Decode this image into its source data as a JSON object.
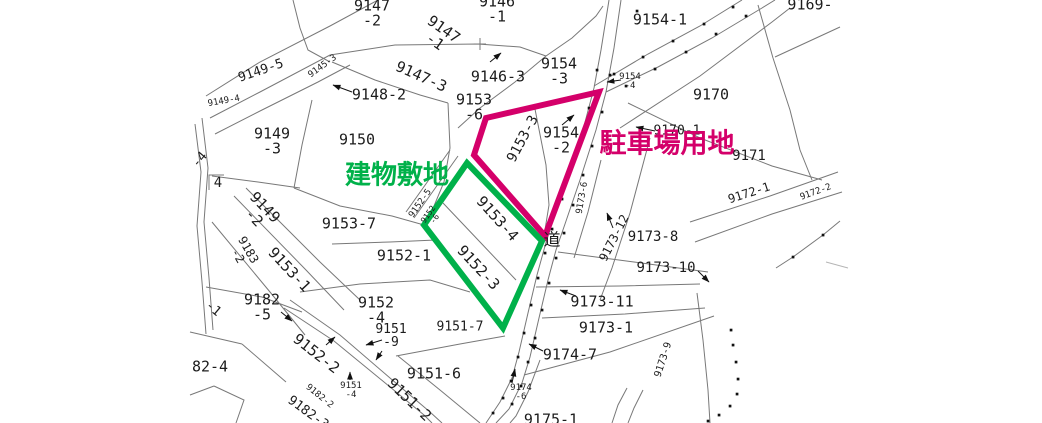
{
  "map_title": "cadastral-parcel-map",
  "overlays": {
    "building_site": {
      "label": "建物敷地",
      "color": "#00b14a",
      "points": "467,163 542,241 503,328 424,225",
      "label_x": 397,
      "label_y": 173,
      "label_size": 26
    },
    "parking_lot": {
      "label": "駐車場用地",
      "color": "#d4006a",
      "points": "486,118 599,92 545,236 474,155",
      "label_x": 667,
      "label_y": 141,
      "label_size": 27
    }
  },
  "road_label": "道",
  "map": {
    "labels": [
      {
        "text": "9147\n-2",
        "x": 372,
        "y": 14,
        "size": 15
      },
      {
        "text": "9146\n-1",
        "x": 497,
        "y": 10,
        "size": 15
      },
      {
        "text": "9154-1",
        "x": 660,
        "y": 20,
        "size": 15
      },
      {
        "text": "9147\n-1",
        "x": 439,
        "y": 36,
        "rot": 35,
        "size": 15
      },
      {
        "text": "9147-3",
        "x": 421,
        "y": 77,
        "rot": 24,
        "size": 15
      },
      {
        "text": "9146-3",
        "x": 498,
        "y": 77,
        "size": 15
      },
      {
        "text": "9154\n-3",
        "x": 559,
        "y": 72,
        "size": 15
      },
      {
        "text": "9148-2",
        "x": 379,
        "y": 95,
        "size": 15
      },
      {
        "text": "9149-5",
        "x": 261,
        "y": 71,
        "rot": -19,
        "size": 13
      },
      {
        "text": "9145-3",
        "x": 323,
        "y": 67,
        "rot": -36,
        "size": 9
      },
      {
        "text": "9149-4",
        "x": 224,
        "y": 102,
        "rot": -10,
        "size": 9
      },
      {
        "text": "9149\n-3",
        "x": 272,
        "y": 142,
        "size": 15
      },
      {
        "text": "9150",
        "x": 357,
        "y": 140,
        "size": 15
      },
      {
        "text": "9153\n-6",
        "x": 474,
        "y": 108,
        "size": 15
      },
      {
        "text": "9153-3",
        "x": 523,
        "y": 139,
        "rot": -62,
        "size": 14
      },
      {
        "text": "9154\n-2",
        "x": 561,
        "y": 141,
        "size": 15
      },
      {
        "text": "9154\n-4",
        "x": 630,
        "y": 82,
        "size": 9
      },
      {
        "text": "9170",
        "x": 711,
        "y": 95,
        "size": 15
      },
      {
        "text": "9170-1",
        "x": 677,
        "y": 131,
        "size": 13
      },
      {
        "text": "9171",
        "x": 749,
        "y": 156,
        "size": 14
      },
      {
        "text": "9169-",
        "x": 810,
        "y": 5,
        "size": 15
      },
      {
        "text": "9172-1",
        "x": 749,
        "y": 193,
        "rot": -18,
        "size": 12
      },
      {
        "text": "9172-2",
        "x": 816,
        "y": 193,
        "rot": -20,
        "size": 9
      },
      {
        "text": "-4",
        "x": 200,
        "y": 160,
        "rot": -50,
        "size": 13
      },
      {
        "text": "4",
        "x": 218,
        "y": 183,
        "size": 14
      },
      {
        "text": "9149\n-2",
        "x": 259,
        "y": 213,
        "rot": 46,
        "size": 15
      },
      {
        "text": "9183\n-2",
        "x": 243,
        "y": 253,
        "rot": 60,
        "size": 12
      },
      {
        "text": "9153-1",
        "x": 289,
        "y": 270,
        "rot": 47,
        "size": 15
      },
      {
        "text": "9153-7",
        "x": 349,
        "y": 224,
        "size": 15
      },
      {
        "text": "9152-1",
        "x": 404,
        "y": 256,
        "size": 15
      },
      {
        "text": "9152-5",
        "x": 421,
        "y": 204,
        "rot": -55,
        "size": 9
      },
      {
        "text": "9152\n-6",
        "x": 432,
        "y": 217,
        "rot": -55,
        "size": 8
      },
      {
        "text": "9153-4",
        "x": 497,
        "y": 219,
        "rot": 48,
        "size": 15
      },
      {
        "text": "9152-3",
        "x": 478,
        "y": 268,
        "rot": 47,
        "size": 15
      },
      {
        "text": "道",
        "x": 552,
        "y": 241,
        "size": 17,
        "cjk": true
      },
      {
        "text": "9182\n-5",
        "x": 262,
        "y": 308,
        "size": 15
      },
      {
        "text": "-1",
        "x": 213,
        "y": 309,
        "rot": 40,
        "size": 13
      },
      {
        "text": "82-4",
        "x": 210,
        "y": 367,
        "size": 15
      },
      {
        "text": "9152\n-4",
        "x": 376,
        "y": 311,
        "size": 15
      },
      {
        "text": "9151\n-9",
        "x": 391,
        "y": 336,
        "size": 13
      },
      {
        "text": "9151-7",
        "x": 460,
        "y": 327,
        "size": 13
      },
      {
        "text": "9152-2",
        "x": 316,
        "y": 354,
        "rot": 38,
        "size": 15
      },
      {
        "text": "9182-2",
        "x": 319,
        "y": 397,
        "rot": 39,
        "size": 9
      },
      {
        "text": "9182-3",
        "x": 308,
        "y": 413,
        "rot": 36,
        "size": 13
      },
      {
        "text": "9151\n-4",
        "x": 351,
        "y": 391,
        "size": 9
      },
      {
        "text": "9151-2",
        "x": 409,
        "y": 400,
        "rot": 44,
        "size": 15
      },
      {
        "text": "9151-6",
        "x": 434,
        "y": 374,
        "size": 15
      },
      {
        "text": "9173-6",
        "x": 583,
        "y": 198,
        "rot": -80,
        "size": 9
      },
      {
        "text": "9173-12",
        "x": 614,
        "y": 238,
        "rot": -63,
        "size": 12
      },
      {
        "text": "9173-8",
        "x": 653,
        "y": 237,
        "size": 14
      },
      {
        "text": "9173-10",
        "x": 666,
        "y": 268,
        "size": 14
      },
      {
        "text": "9173-11",
        "x": 602,
        "y": 302,
        "size": 15
      },
      {
        "text": "9173-1",
        "x": 606,
        "y": 328,
        "size": 15
      },
      {
        "text": "9174-7",
        "x": 570,
        "y": 355,
        "size": 15
      },
      {
        "text": "9174\n-6",
        "x": 521,
        "y": 393,
        "size": 9
      },
      {
        "text": "9173-9",
        "x": 664,
        "y": 360,
        "rot": -72,
        "size": 10
      },
      {
        "text": "9175-1",
        "x": 551,
        "y": 420,
        "size": 15
      }
    ]
  },
  "colors": {
    "boundary_line": "#787878",
    "survey_dot": "#111111",
    "text": "#1c1c1c"
  }
}
